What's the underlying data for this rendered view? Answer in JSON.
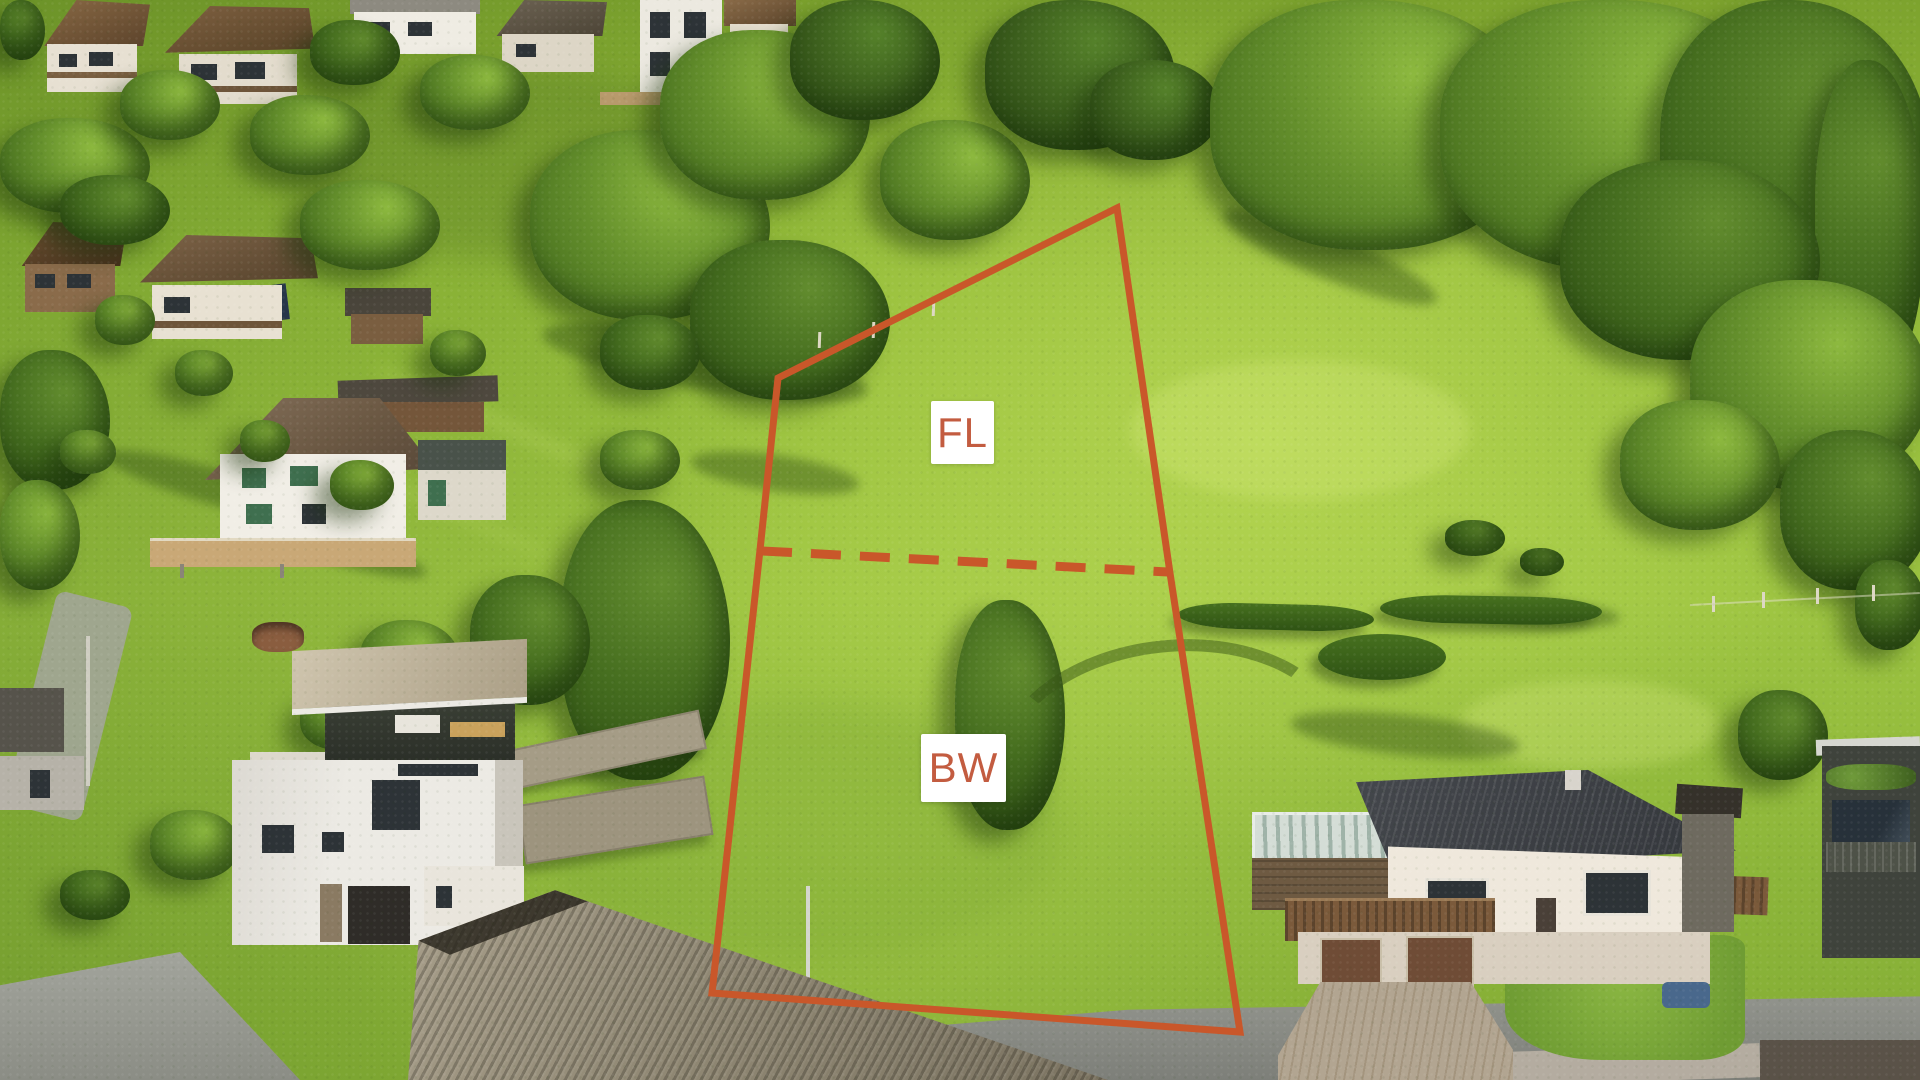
{
  "annotation": {
    "boundary_color": "#c9572a",
    "label_text_color": "#c35c40",
    "label_background": "#ffffff",
    "boundary_points": "1117,208 778,378 760,550 712,993 1240,1032 1170,573",
    "divider_path": "M 762 551 L 1168 572",
    "parcels": [
      {
        "label": "FL"
      },
      {
        "label": "BW"
      }
    ]
  }
}
